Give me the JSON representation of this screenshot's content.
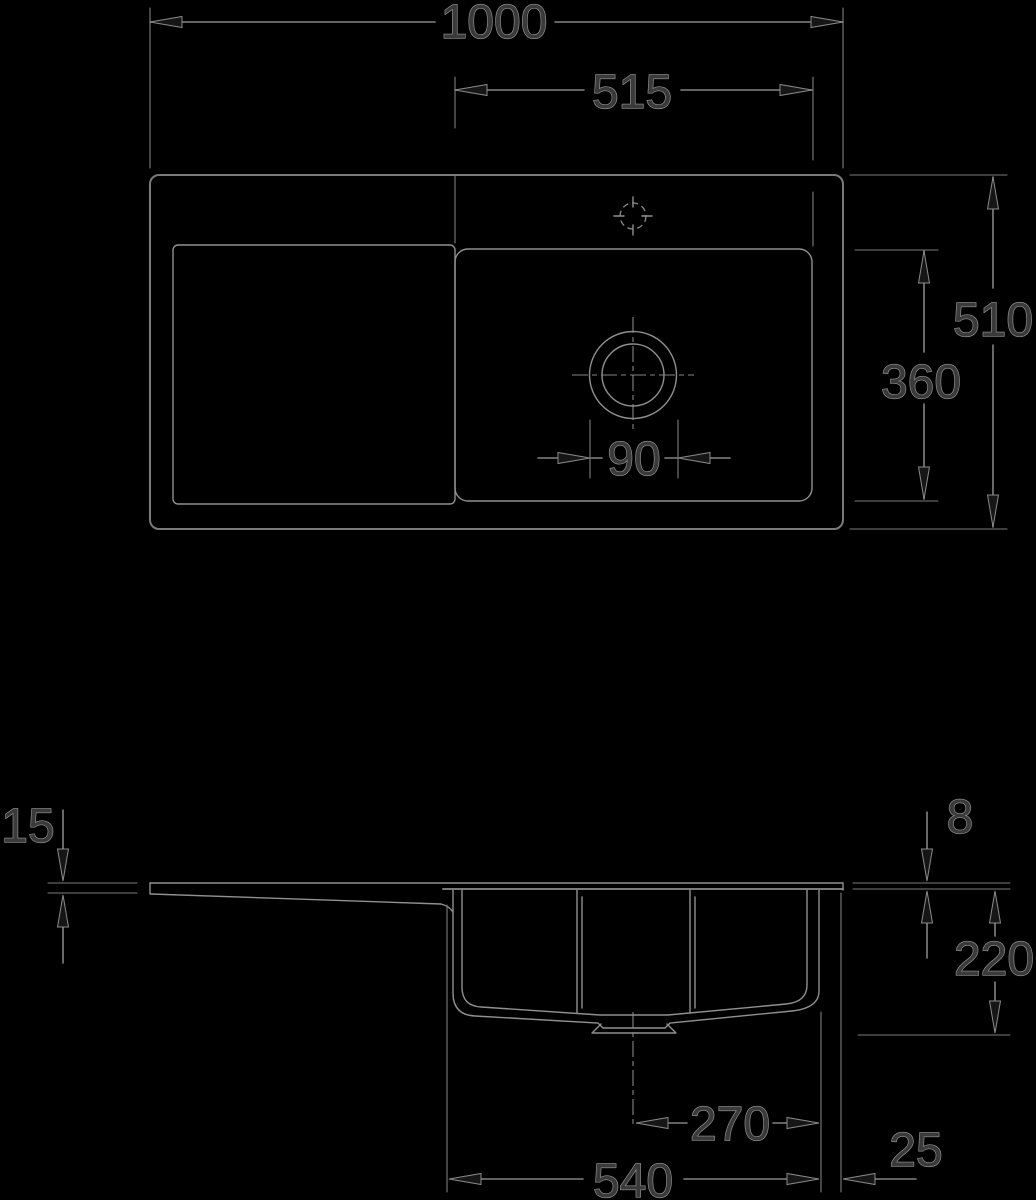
{
  "drawing_type": "sink technical dimension drawing",
  "colors": {
    "background": "#000000",
    "line": "#909090",
    "dimension_line": "#828282",
    "text_fill": "#3a3a3a",
    "text_outline": "#989898"
  },
  "top_view": {
    "overall_width": "1000",
    "bowl_width": "515",
    "overall_depth": "510",
    "bowl_depth": "360",
    "drain_diameter": "90"
  },
  "side_view": {
    "left_edge_height": "15",
    "rim_height": "8",
    "bowl_depth": "220",
    "drain_center_to_right": "270",
    "bowl_length": "540",
    "rim_overhang": "25"
  }
}
